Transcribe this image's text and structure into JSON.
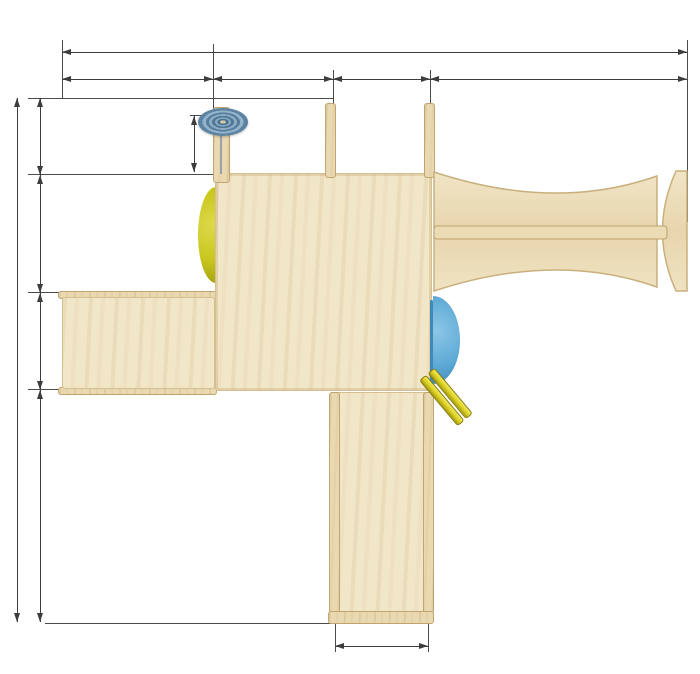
{
  "units": "см",
  "dims": {
    "top_total": "394,5 см",
    "top_segments": [
      "99 см",
      "76 см",
      "63 см",
      "156,5 см"
    ],
    "left_total": "324,5 см",
    "left_segments": [
      "41 см",
      "76 см",
      "63 см",
      "144,5 см"
    ],
    "wheel_offset": "30 см",
    "bottom": "63 см"
  },
  "watermark": {
    "letter_s": "S",
    "letter_g": "G",
    "orange": "#e0904f",
    "green": "#8dbd57"
  },
  "colors": {
    "dimension_line": "#3d3d3d",
    "plywood": "#f2e6c9",
    "rail_wood": "#e9d8b0",
    "ball_blue": "#6fc0e4",
    "ball_yellow": "#d2ca24",
    "ball_red": "#d52a2e",
    "bar_red": "#cf2328",
    "bar_yellow": "#d9cf28",
    "bar_blue": "#7cbbdb",
    "net_ring_navy": "#252f6f",
    "net_rope_black": "#1d1d1d",
    "wheel_steel_blue": "#5c83a1",
    "side_disc_blue": "#5fabd7",
    "side_disc_yellow": "#c9c71e"
  },
  "structure": {
    "top_bars": {
      "x": 336,
      "w": 90,
      "h": 6,
      "items": [
        {
          "y": 111,
          "c": "yellow"
        },
        {
          "y": 117.5,
          "c": "red"
        },
        {
          "y": 124,
          "c": "yellow"
        },
        {
          "y": 130.5,
          "c": "blue"
        },
        {
          "y": 140.5,
          "c": "red"
        },
        {
          "y": 152,
          "c": "blue"
        }
      ]
    },
    "ladder_rungs": {
      "x": 336,
      "w": 92,
      "h": 8,
      "items": [
        {
          "y": 405,
          "c": "red",
          "x": 330,
          "w": 106
        },
        {
          "y": 438,
          "c": "yellow"
        },
        {
          "y": 470,
          "c": "blue"
        },
        {
          "y": 503,
          "c": "yellow"
        },
        {
          "y": 534,
          "c": "blue"
        },
        {
          "y": 566,
          "c": "red"
        },
        {
          "y": 599,
          "c": "yellow"
        }
      ]
    },
    "balls": [
      {
        "x": 219,
        "y": 180,
        "r": 10,
        "c": "blue"
      },
      {
        "x": 331,
        "y": 180,
        "r": 10,
        "c": "blue"
      },
      {
        "x": 433,
        "y": 180,
        "r": 10,
        "c": "blue"
      },
      {
        "x": 219,
        "y": 287,
        "r": 10,
        "c": "blue"
      },
      {
        "x": 434,
        "y": 286,
        "r": 10,
        "c": "blue"
      },
      {
        "x": 221,
        "y": 394,
        "r": 10,
        "c": "blue"
      },
      {
        "x": 328,
        "y": 394,
        "r": 10,
        "c": "blue"
      },
      {
        "x": 222,
        "y": 169,
        "r": 9,
        "c": "blue"
      },
      {
        "x": 222,
        "y": 181,
        "r": 9,
        "c": "blue"
      },
      {
        "x": 107,
        "y": 315,
        "r": 9,
        "c": "yellow"
      },
      {
        "x": 154,
        "y": 315,
        "r": 9,
        "c": "blue"
      },
      {
        "x": 201,
        "y": 315,
        "r": 9,
        "c": "red"
      },
      {
        "x": 83,
        "y": 367,
        "r": 9,
        "c": "blue"
      },
      {
        "x": 131,
        "y": 367,
        "r": 9,
        "c": "red"
      },
      {
        "x": 178,
        "y": 367,
        "r": 9,
        "c": "yellow"
      },
      {
        "x": 253,
        "y": 402,
        "r": 6,
        "c": "blue"
      },
      {
        "x": 292,
        "y": 403,
        "r": 6,
        "c": "yellow"
      },
      {
        "x": 328,
        "y": 420,
        "r": 7,
        "c": "yellow"
      },
      {
        "x": 326,
        "y": 443,
        "r": 7,
        "c": "yellow"
      },
      {
        "x": 327,
        "y": 473,
        "r": 7,
        "c": "red"
      },
      {
        "x": 327,
        "y": 516,
        "r": 7,
        "c": "red"
      },
      {
        "x": 331,
        "y": 523,
        "r": 7,
        "c": "blue"
      },
      {
        "x": 328,
        "y": 577,
        "r": 7,
        "c": "yellow"
      },
      {
        "x": 436,
        "y": 418,
        "r": 7,
        "c": "yellow"
      },
      {
        "x": 436,
        "y": 443,
        "r": 7,
        "c": "yellow"
      },
      {
        "x": 437,
        "y": 473,
        "r": 7,
        "c": "red"
      },
      {
        "x": 436,
        "y": 515,
        "r": 7,
        "c": "red"
      },
      {
        "x": 438,
        "y": 521,
        "r": 7,
        "c": "blue"
      },
      {
        "x": 437,
        "y": 577,
        "r": 7,
        "c": "yellow"
      }
    ],
    "ramp_holes": [
      {
        "x": 87,
        "y": 315,
        "t": "white"
      },
      {
        "x": 134,
        "y": 313,
        "t": "dark"
      },
      {
        "x": 182,
        "y": 312,
        "t": "dark"
      },
      {
        "x": 110,
        "y": 367,
        "t": "dark"
      },
      {
        "x": 158,
        "y": 366,
        "t": "dark"
      },
      {
        "x": 207,
        "y": 367,
        "t": "white"
      }
    ],
    "edge_dashes": {
      "y": 174,
      "h": 4,
      "items": [
        {
          "x": 232,
          "w": 9,
          "c": "red"
        },
        {
          "x": 244,
          "w": 13,
          "c": "blue"
        },
        {
          "x": 260,
          "w": 9,
          "c": "blue"
        },
        {
          "x": 273,
          "w": 8,
          "c": "red"
        },
        {
          "x": 297,
          "w": 11,
          "c": "red"
        },
        {
          "x": 311,
          "w": 9,
          "c": "blue"
        }
      ]
    },
    "red_parts": [
      {
        "x": 217,
        "y": 152,
        "w": 7,
        "h": 9
      },
      {
        "x": 324,
        "y": 162,
        "w": 7,
        "h": 13
      },
      {
        "x": 203,
        "y": 279,
        "w": 13,
        "h": 6
      },
      {
        "x": 208,
        "y": 285,
        "w": 6,
        "h": 9
      },
      {
        "x": 203,
        "y": 387,
        "w": 13,
        "h": 6
      },
      {
        "x": 216,
        "y": 396,
        "w": 6,
        "h": 15
      },
      {
        "x": 204,
        "y": 396,
        "w": 13,
        "h": 6
      }
    ],
    "web": {
      "cx": 563,
      "cy": 231,
      "ring_r": 76,
      "spokes": 18,
      "rings": [
        [
          12,
          8
        ],
        [
          24,
          17
        ],
        [
          37,
          29
        ],
        [
          50,
          43
        ],
        [
          62,
          56
        ],
        [
          71,
          68
        ]
      ]
    }
  }
}
